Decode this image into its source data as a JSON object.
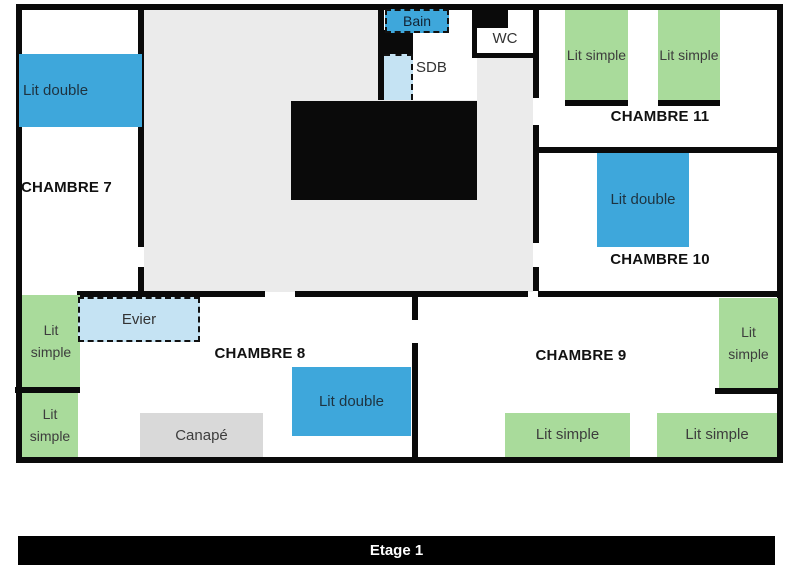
{
  "floor_label": "Etage 1",
  "rooms": [
    {
      "name": "CHAMBRE 7"
    },
    {
      "name": "CHAMBRE 8"
    },
    {
      "name": "CHAMBRE 9"
    },
    {
      "name": "CHAMBRE 10"
    },
    {
      "name": "CHAMBRE 11"
    }
  ],
  "fixtures": {
    "bain": "Bain",
    "sdb": "SDB",
    "wc": "WC",
    "evier": "Evier",
    "canape": "Canapé"
  },
  "beds": [
    {
      "room": "CHAMBRE 7",
      "type": "double",
      "label": "Lit double"
    },
    {
      "room": "CHAMBRE 11",
      "type": "simple",
      "label": "Lit simple"
    },
    {
      "room": "CHAMBRE 11",
      "type": "simple",
      "label": "Lit simple"
    },
    {
      "room": "CHAMBRE 10",
      "type": "double",
      "label": "Lit double"
    },
    {
      "room": "CHAMBRE 8",
      "type": "simple",
      "label": "Lit simple"
    },
    {
      "room": "CHAMBRE 8",
      "type": "simple",
      "label": "Lit simple"
    },
    {
      "room": "CHAMBRE 8",
      "type": "double",
      "label": "Lit double"
    },
    {
      "room": "CHAMBRE 9",
      "type": "simple",
      "label": "Lit simple"
    },
    {
      "room": "CHAMBRE 9",
      "type": "simple",
      "label": "Lit simple"
    },
    {
      "room": "CHAMBRE 9",
      "type": "simple",
      "label": "Lit simple"
    }
  ],
  "colors": {
    "bed_double": "#3ea7db",
    "bed_simple": "#a9db9b",
    "fixture_light_blue": "#c5e3f3",
    "sofa_gray": "#d9d9d9",
    "hall_gray": "#ebebeb",
    "wall": "#0a0a0a"
  }
}
